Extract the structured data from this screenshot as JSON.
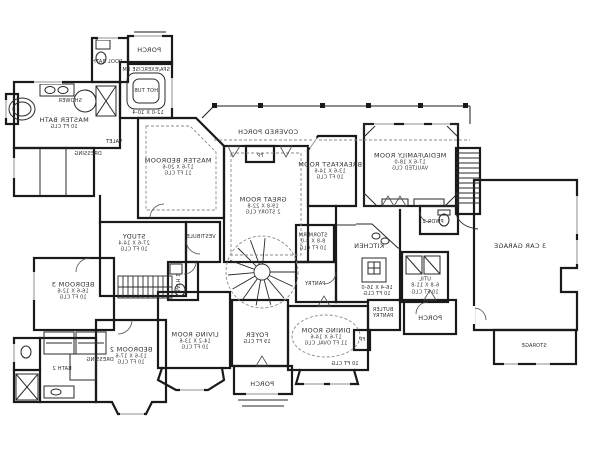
{
  "drawing": {
    "type": "single-story house floor plan (mirrored print)",
    "mirrored_text": true,
    "background_color": "#ffffff",
    "wall_color": "#1a1a1a",
    "annotation_color": "#2e2e2e"
  },
  "rooms": {
    "porch_top": {
      "name": "PORCH"
    },
    "pool_bath": {
      "name": "POOL BATH"
    },
    "spa": {
      "name": "SPA/EXERCISE RM",
      "dims": "12-0 X 10-4"
    },
    "hot_tub": {
      "name": "HOT TUB"
    },
    "master_bath": {
      "name": "MASTER BATH",
      "clg": "10 FT CLG"
    },
    "shower": {
      "name": "SHOWER"
    },
    "valet": {
      "name": "VALET"
    },
    "dressing_master": {
      "name": "DRESSING"
    },
    "master_bedroom": {
      "name": "MASTER BEDROOM",
      "dims": "17-6 X 20-6",
      "clg": "11 FT CLG"
    },
    "covered_porch": {
      "name": "COVERED PORCH"
    },
    "great_room": {
      "name": "GREAT ROOM",
      "dims": "19-8 X 22-8",
      "clg": "2 STORY CLG"
    },
    "fireplace": {
      "name": "FP"
    },
    "breakfast_room": {
      "name": "BREAKFAST ROOM",
      "dims": "13-6 X 14-6",
      "clg": "10 FT CLG"
    },
    "media_family_room": {
      "name": "MEDIA/FAMILY ROOM",
      "dims": "17-6 X 18-0",
      "clg": "VAULTED CLG"
    },
    "powder_2": {
      "name": "PWDR 2"
    },
    "storm_room": {
      "name": "STORM RM",
      "dims": "8-8 X 8-0",
      "clg": "10 FT CLG"
    },
    "kitchen": {
      "name": "KITCHEN",
      "dims": "16-4 X 16-0",
      "clg": "10 FT CLG"
    },
    "pantry": {
      "name": "PANTRY"
    },
    "butler_pantry": {
      "name": "BUTLER PANTRY"
    },
    "utility": {
      "name": "UTIL",
      "dims": "6-8 X 11-8",
      "clg": "10 FT CLG"
    },
    "dining_room": {
      "name": "DINING ROOM",
      "dims": "17-6 X 14-6",
      "clg": "11 FT OVAL CLG"
    },
    "bay_clg_note": {
      "name": "10 FT CLG"
    },
    "foyer": {
      "name": "FOYER",
      "clg": "19 FT CLG"
    },
    "porch_front": {
      "name": "PORCH"
    },
    "living_room": {
      "name": "LIVING ROOM",
      "dims": "14-2 X 13-6",
      "clg": "10 FT CLG"
    },
    "bedroom_2": {
      "name": "BEDROOM 2",
      "dims": "13-6 X 17-6",
      "clg": "10 FT CLG"
    },
    "bath_2": {
      "name": "BATH 2"
    },
    "dressing_2": {
      "name": "DRESSING"
    },
    "bedroom_3": {
      "name": "BEDROOM 3",
      "dims": "16-6 X 12-6",
      "clg": "10 FT CLG"
    },
    "study": {
      "name": "STUDY",
      "dims": "27-6 X 14-4",
      "clg": "10 FT CLG"
    },
    "vestibule": {
      "name": "VESTIBULE"
    },
    "bath_1": {
      "name": "BATH 1"
    },
    "garage": {
      "name": "3 CAR GARAGE"
    },
    "storage": {
      "name": "STORAGE"
    },
    "porch_rear": {
      "name": "PORCH"
    }
  }
}
